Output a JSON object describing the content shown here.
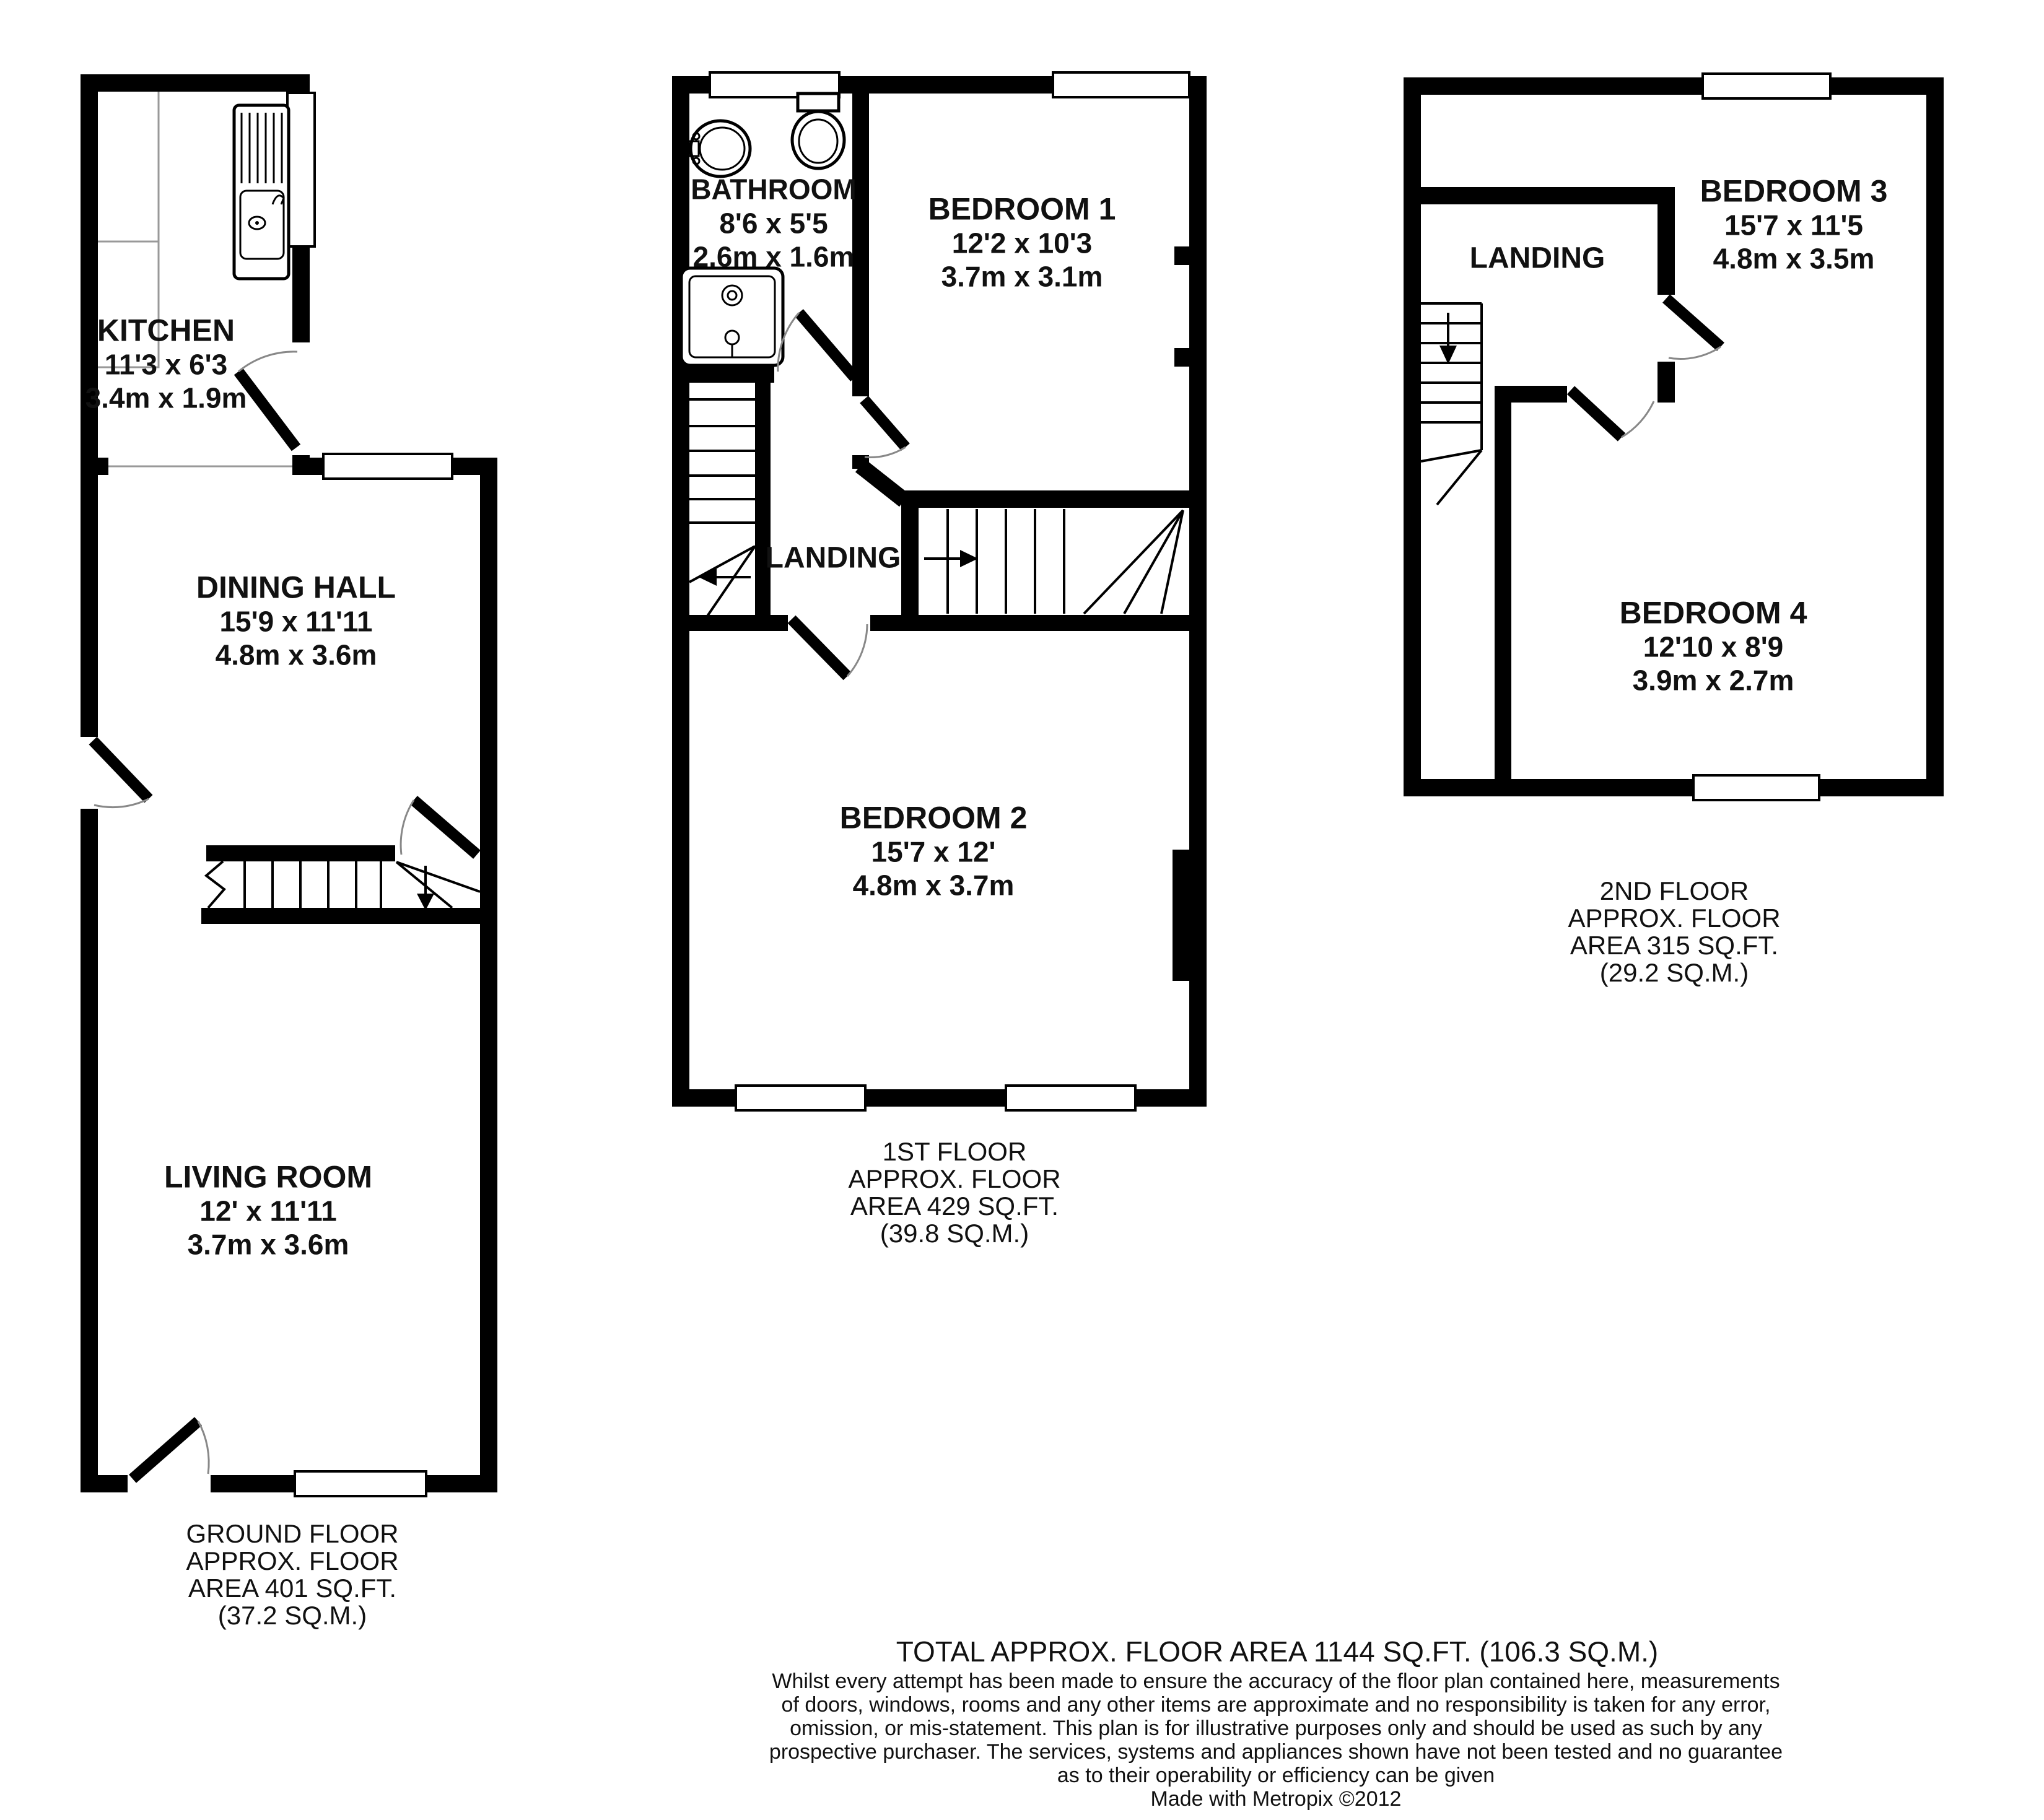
{
  "ground": {
    "kitchen": {
      "name": "KITCHEN",
      "size_imperial": "11'3 x 6'3",
      "size_metric": "3.4m x 1.9m"
    },
    "dining_hall": {
      "name": "DINING HALL",
      "size_imperial": "15'9 x 11'11",
      "size_metric": "4.8m x 3.6m"
    },
    "living_room": {
      "name": "LIVING ROOM",
      "size_imperial": "12' x 11'11",
      "size_metric": "3.7m x 3.6m"
    },
    "caption": [
      "GROUND FLOOR",
      "APPROX. FLOOR",
      "AREA 401 SQ.FT.",
      "(37.2 SQ.M.)"
    ]
  },
  "first": {
    "bathroom": {
      "name": "BATHROOM",
      "size_imperial": "8'6 x 5'5",
      "size_metric": "2.6m x 1.6m"
    },
    "bedroom1": {
      "name": "BEDROOM 1",
      "size_imperial": "12'2 x 10'3",
      "size_metric": "3.7m x 3.1m"
    },
    "landing": {
      "name": "LANDING"
    },
    "bedroom2": {
      "name": "BEDROOM 2",
      "size_imperial": "15'7 x 12'",
      "size_metric": "4.8m x 3.7m"
    },
    "caption": [
      "1ST FLOOR",
      "APPROX. FLOOR",
      "AREA 429 SQ.FT.",
      "(39.8 SQ.M.)"
    ]
  },
  "second": {
    "bedroom3": {
      "name": "BEDROOM 3",
      "size_imperial": "15'7 x 11'5",
      "size_metric": "4.8m x 3.5m"
    },
    "landing": {
      "name": "LANDING"
    },
    "bedroom4": {
      "name": "BEDROOM 4",
      "size_imperial": "12'10 x 8'9",
      "size_metric": "3.9m x 2.7m"
    },
    "caption": [
      "2ND FLOOR",
      "APPROX. FLOOR",
      "AREA 315 SQ.FT.",
      "(29.2 SQ.M.)"
    ]
  },
  "footer": {
    "total": "TOTAL APPROX. FLOOR AREA 1144 SQ.FT. (106.3 SQ.M.)",
    "disclaimer_lines": [
      "Whilst every attempt has been made to ensure the accuracy of the floor plan contained here, measurements",
      "of doors, windows, rooms and any other items are approximate and no responsibility is taken for any error,",
      "omission, or mis-statement. This plan is for illustrative purposes only and should be used as such by any",
      "prospective purchaser. The services, systems and appliances shown have not been tested and no guarantee",
      "as to their operability or efficiency can be given"
    ],
    "credit": "Made with Metropix ©2012"
  },
  "colors": {
    "walls": "#000000",
    "background": "#ffffff",
    "door_arc": "#888888",
    "room_divider": "#999999"
  }
}
